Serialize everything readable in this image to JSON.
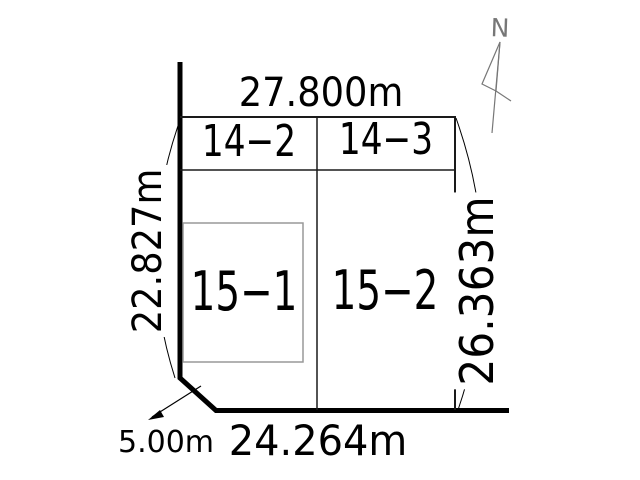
{
  "diagram": {
    "type": "land-parcel-survey-plan",
    "north_label": "N",
    "dimensions": {
      "top": "27.800m",
      "left": "22.827m",
      "right": "26.363m",
      "bottom": "24.264m",
      "corner_cut": "5.00m"
    },
    "parcels": {
      "top_left": "14−2",
      "top_right": "14−3",
      "main_left": "15−1",
      "main_right": "15−2"
    },
    "colors": {
      "background": "#ffffff",
      "boundary_line": "#000000",
      "thin_line": "#1a1a1a",
      "inner_rect_line": "#999999",
      "north_arrow": "#777777"
    }
  }
}
